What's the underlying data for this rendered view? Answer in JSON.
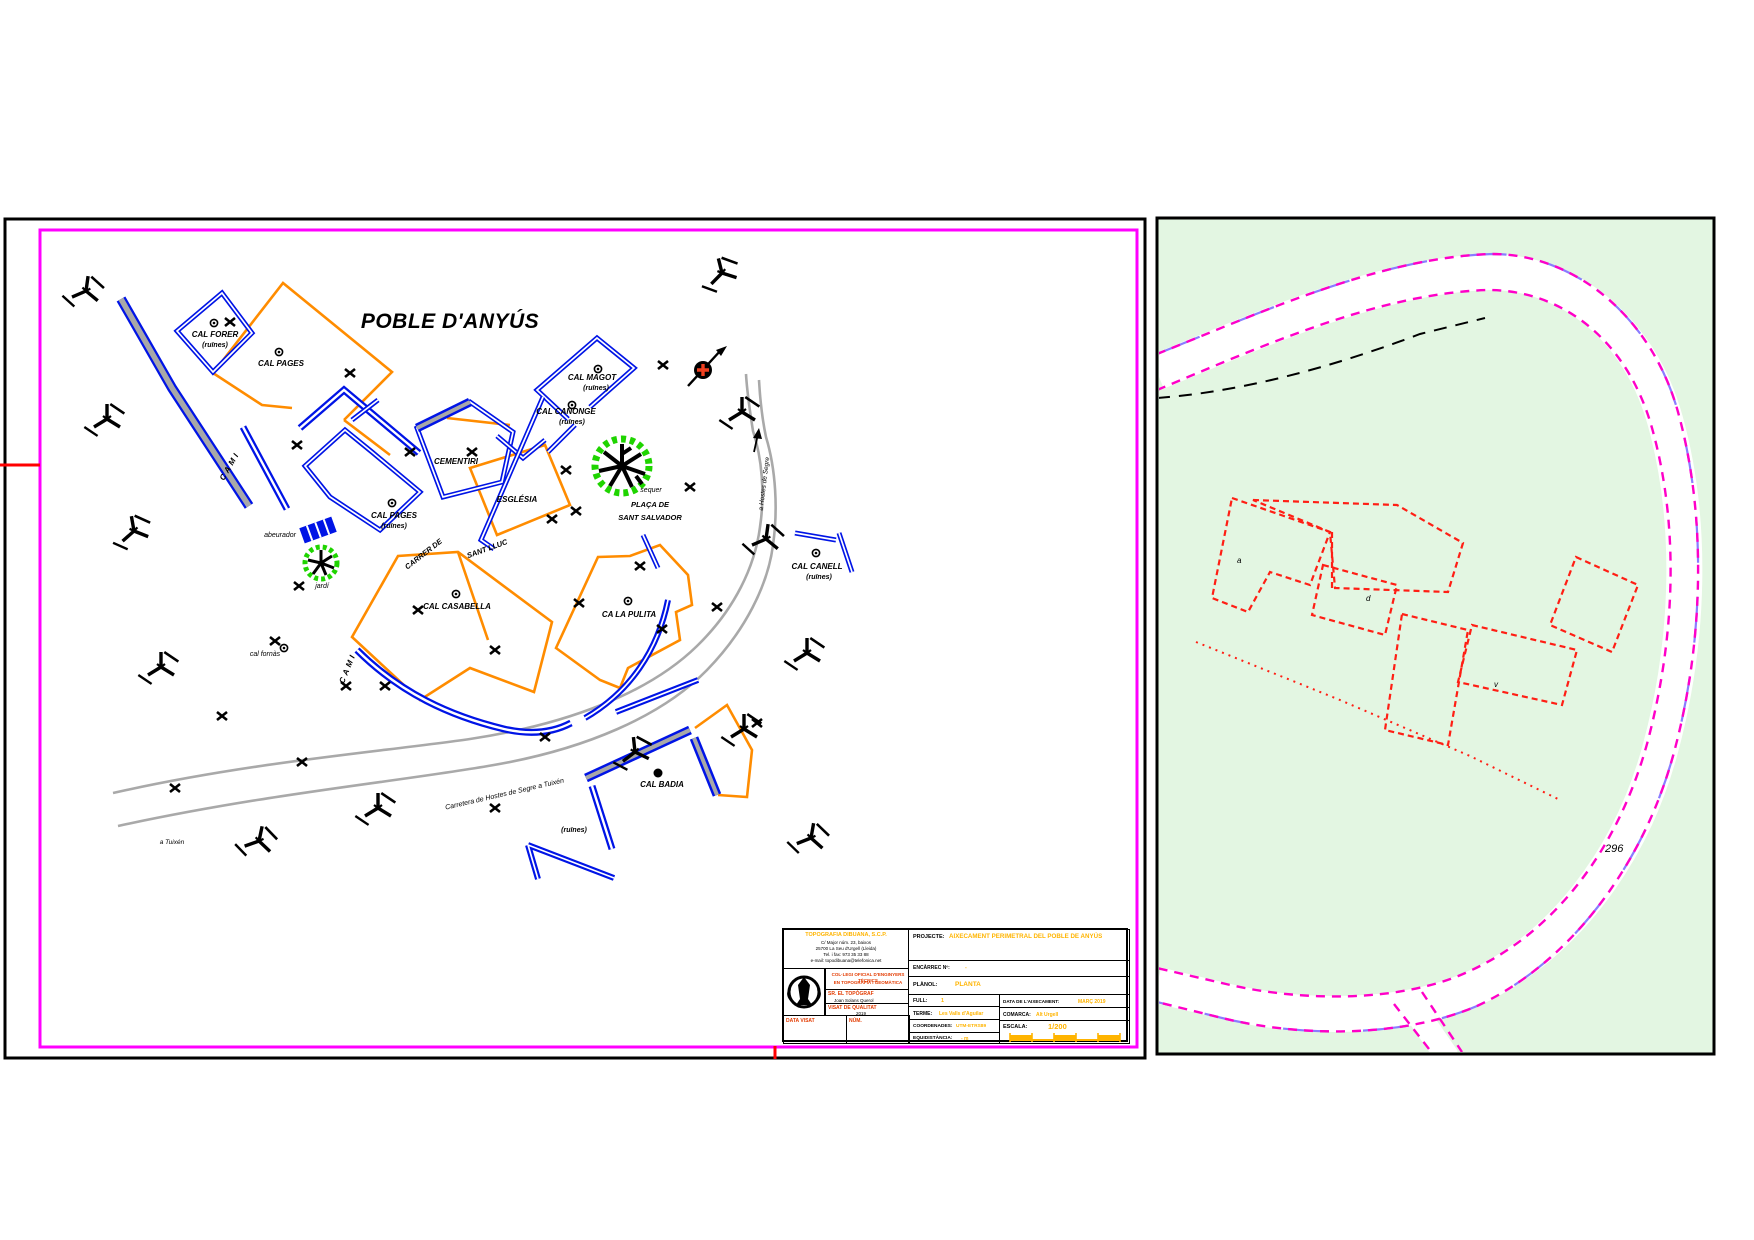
{
  "left_panel": {
    "title": "POBLE D'ANYÚS",
    "labels": {
      "cal_forer": {
        "name": "CAL FORER",
        "note": "(ruïnes)"
      },
      "cal_pages_top": {
        "name": "CAL PAGES"
      },
      "cal_pages_r": {
        "name": "CAL PAGES",
        "note": "(ruïnes)"
      },
      "cementiri": {
        "name": "CEMENTIRI"
      },
      "esglesia": {
        "name": "ESGLÉSIA"
      },
      "cal_magot": {
        "name": "CAL MAGOT",
        "note": "(ruïnes)"
      },
      "cal_canonge": {
        "name": "CAL CANONGE",
        "note": "(ruïnes)"
      },
      "cal_casabella": {
        "name": "CAL CASABELLA"
      },
      "ca_la_pulida": {
        "name": "CA LA PULITA"
      },
      "cal_canell": {
        "name": "CAL CANELL",
        "note": "(ruïnes)"
      },
      "cal_badia": {
        "name": "CAL BADIA",
        "note": "(ruïnes)"
      },
      "cal_fornas": {
        "name": "cal fornàs"
      }
    },
    "places": {
      "sequer": "sequer",
      "placa_line1": "PLAÇA DE",
      "placa_line2": "SANT SALVADOR",
      "jardi": "jardí",
      "abeurador": "abeurador"
    },
    "streets": {
      "carrer_de": "CARRER DE",
      "sant_lluc": "SANT LLUC",
      "cami_nw": "CAMI",
      "cami_sw": "CAMI",
      "carretera": "Carretera de Hostes de Segre a Tuixén",
      "road_north": "a Hostes de Segre",
      "a_tuixen": "a Tuixén"
    }
  },
  "right_panel": {
    "parcel_number": "296",
    "letters": {
      "a": "a",
      "d": "d",
      "v": "v"
    }
  },
  "title_block": {
    "company": {
      "name": "TOPOGRAFIA DIBUANA, S.C.P.",
      "addr1": "C/ Major núm. 23, baixos",
      "addr2": "25700 La Seu d'Urgell (Lleida)",
      "addr3": "Tel. i fax: 973 35 33 88",
      "addr4": "e-mail: topodibuana@telefonica.net",
      "college_line1": "COL·LEGI OFICIAL D'ENGINYERS TÈCNICS",
      "college_line2": "EN TOPOGRAFIA I GEOMÀTICA",
      "surveyor_title": "SR. EL TOPÒGRAF",
      "surveyor_name": "Joan Solans Querol",
      "visat_title": "VISAT DE QUALITAT",
      "visat_value": "2019",
      "data_visat": "DATA VISAT",
      "num_visat": "NÚM."
    },
    "fields": {
      "projecte_label": "PROJECTE:",
      "projecte_value": "AIXECAMENT PERIMETRAL DEL POBLE DE ANYÚS",
      "encarrec_label": "ENCÀRREC Nº:",
      "encarrec_value": "-",
      "planol_label": "PLÀNOL:",
      "planol_value": "PLANTA",
      "full_label": "FULL:",
      "full_value": "1",
      "terme_label": "TERME:",
      "terme_value": "Les Valls d'Aguilar",
      "coordenades_label": "COORDENADES:",
      "coordenades_value": "UTM-ETRS89",
      "equidistancia_label": "EQUIDISTÀNCIA:",
      "equidistancia_value": "- m",
      "data_label": "DATA DE L'AIXECAMENT:",
      "data_value": "MARÇ 2019",
      "comarca_label": "COMARCA:",
      "comarca_value": "Alt Urgell",
      "escala_label": "ESCALA:",
      "escala_value": "1/200"
    }
  }
}
